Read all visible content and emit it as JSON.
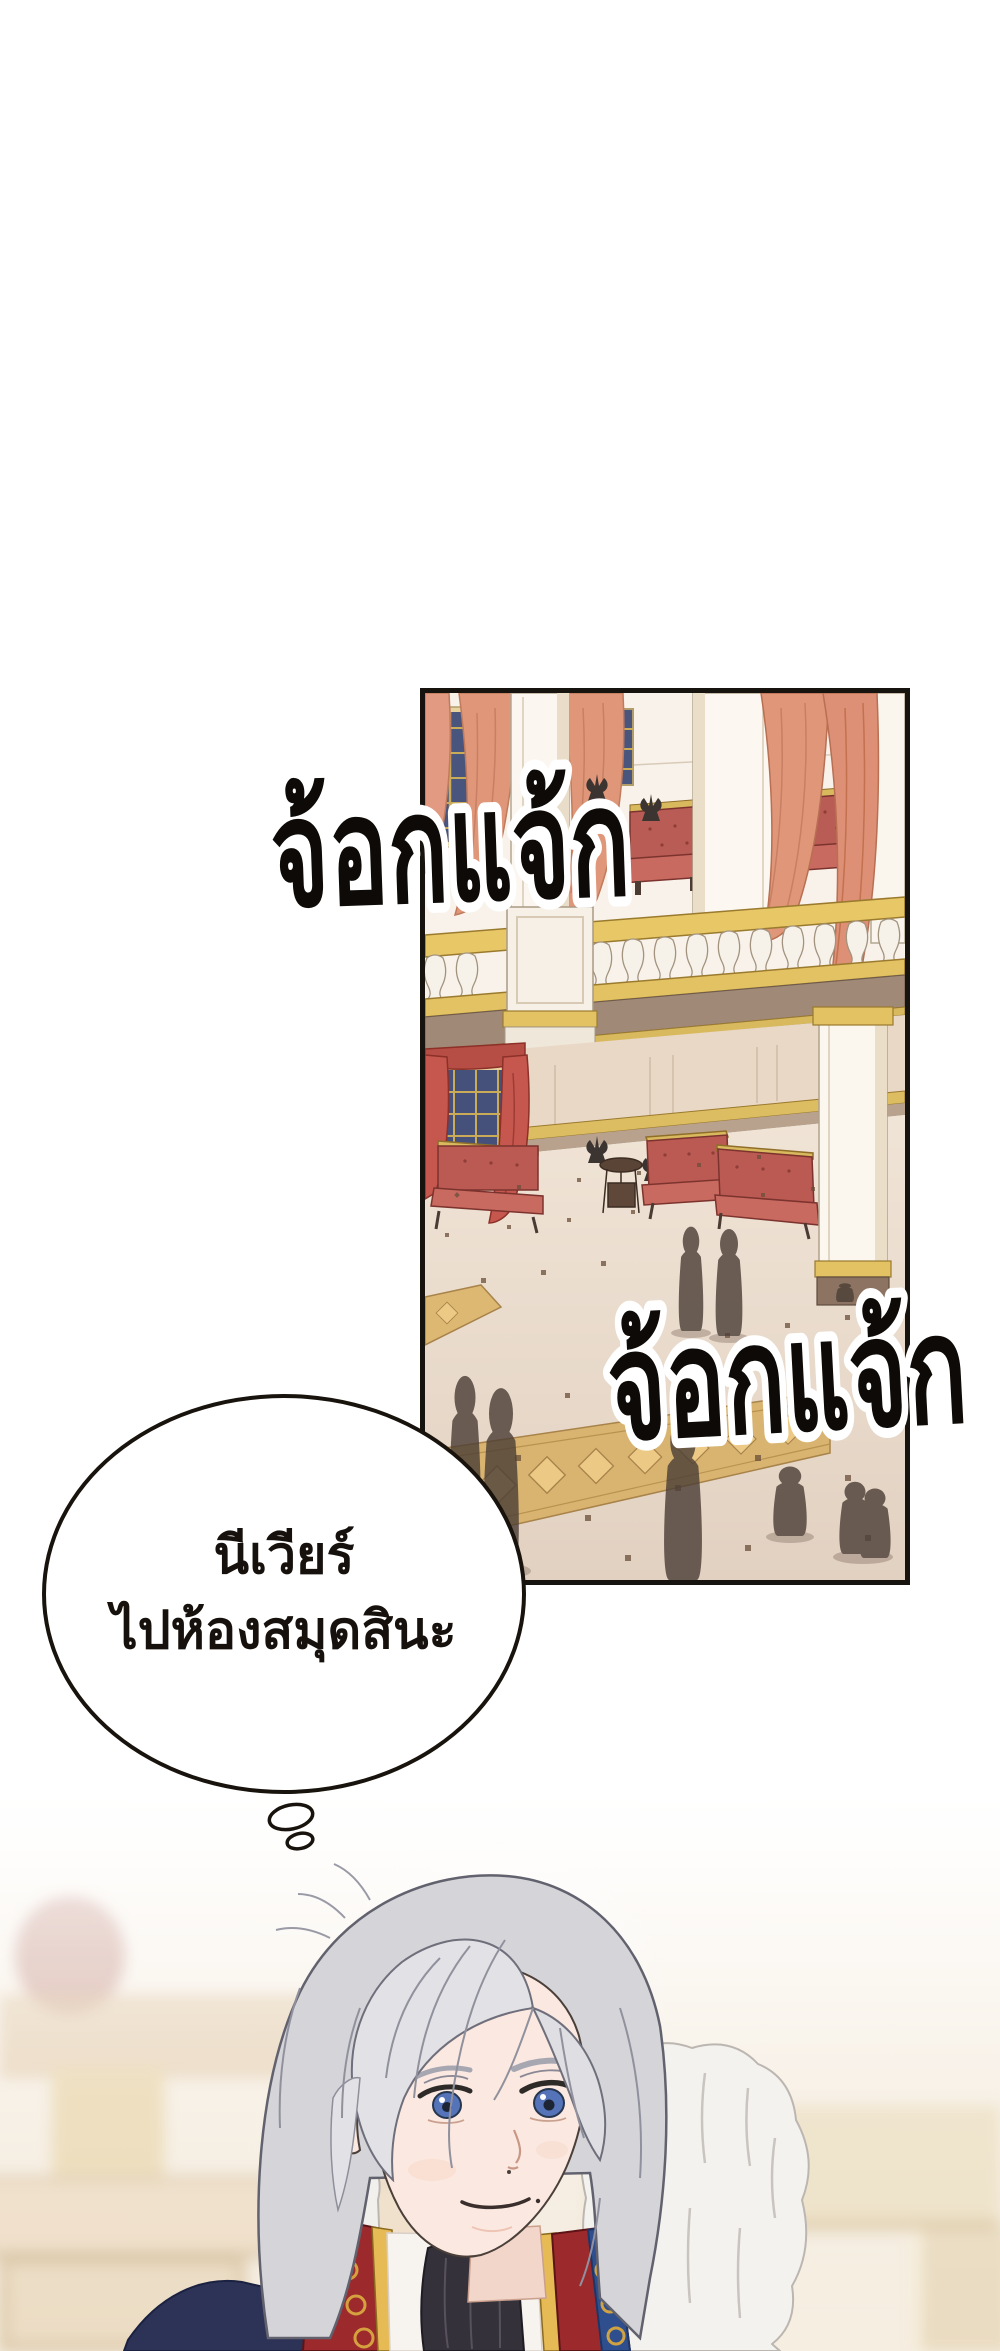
{
  "sfx": {
    "top": "จ้อกแจ้ก",
    "bottom": "จ้อกแจ้ก"
  },
  "thought_bubble": {
    "line1": "นีเวียร์",
    "line2": "ไปห้องสมุดสินะ"
  },
  "colors": {
    "page_background": "#ffffff",
    "panel_border": "#17130f",
    "sfx_fill": "#0d0a07",
    "sfx_outline": "#ffffff",
    "wall_cream": "#f7f1e8",
    "gold_trim": "#e3c263",
    "balcony_fascia": "#a18977",
    "sofa_red": "#bb5a53",
    "curtain_salmon": "#e09678",
    "curtain_red": "#c5574e",
    "window_blue": "#4a557e",
    "carpet_gold": "#d9b470",
    "silhouette": "#4e4038",
    "hair_silver": "#d8d8dc",
    "eye_blue": "#5473b8",
    "coat_navy": "#2c3357",
    "collar_red": "#9c2a2d",
    "fur_white": "#f4f2ef"
  }
}
